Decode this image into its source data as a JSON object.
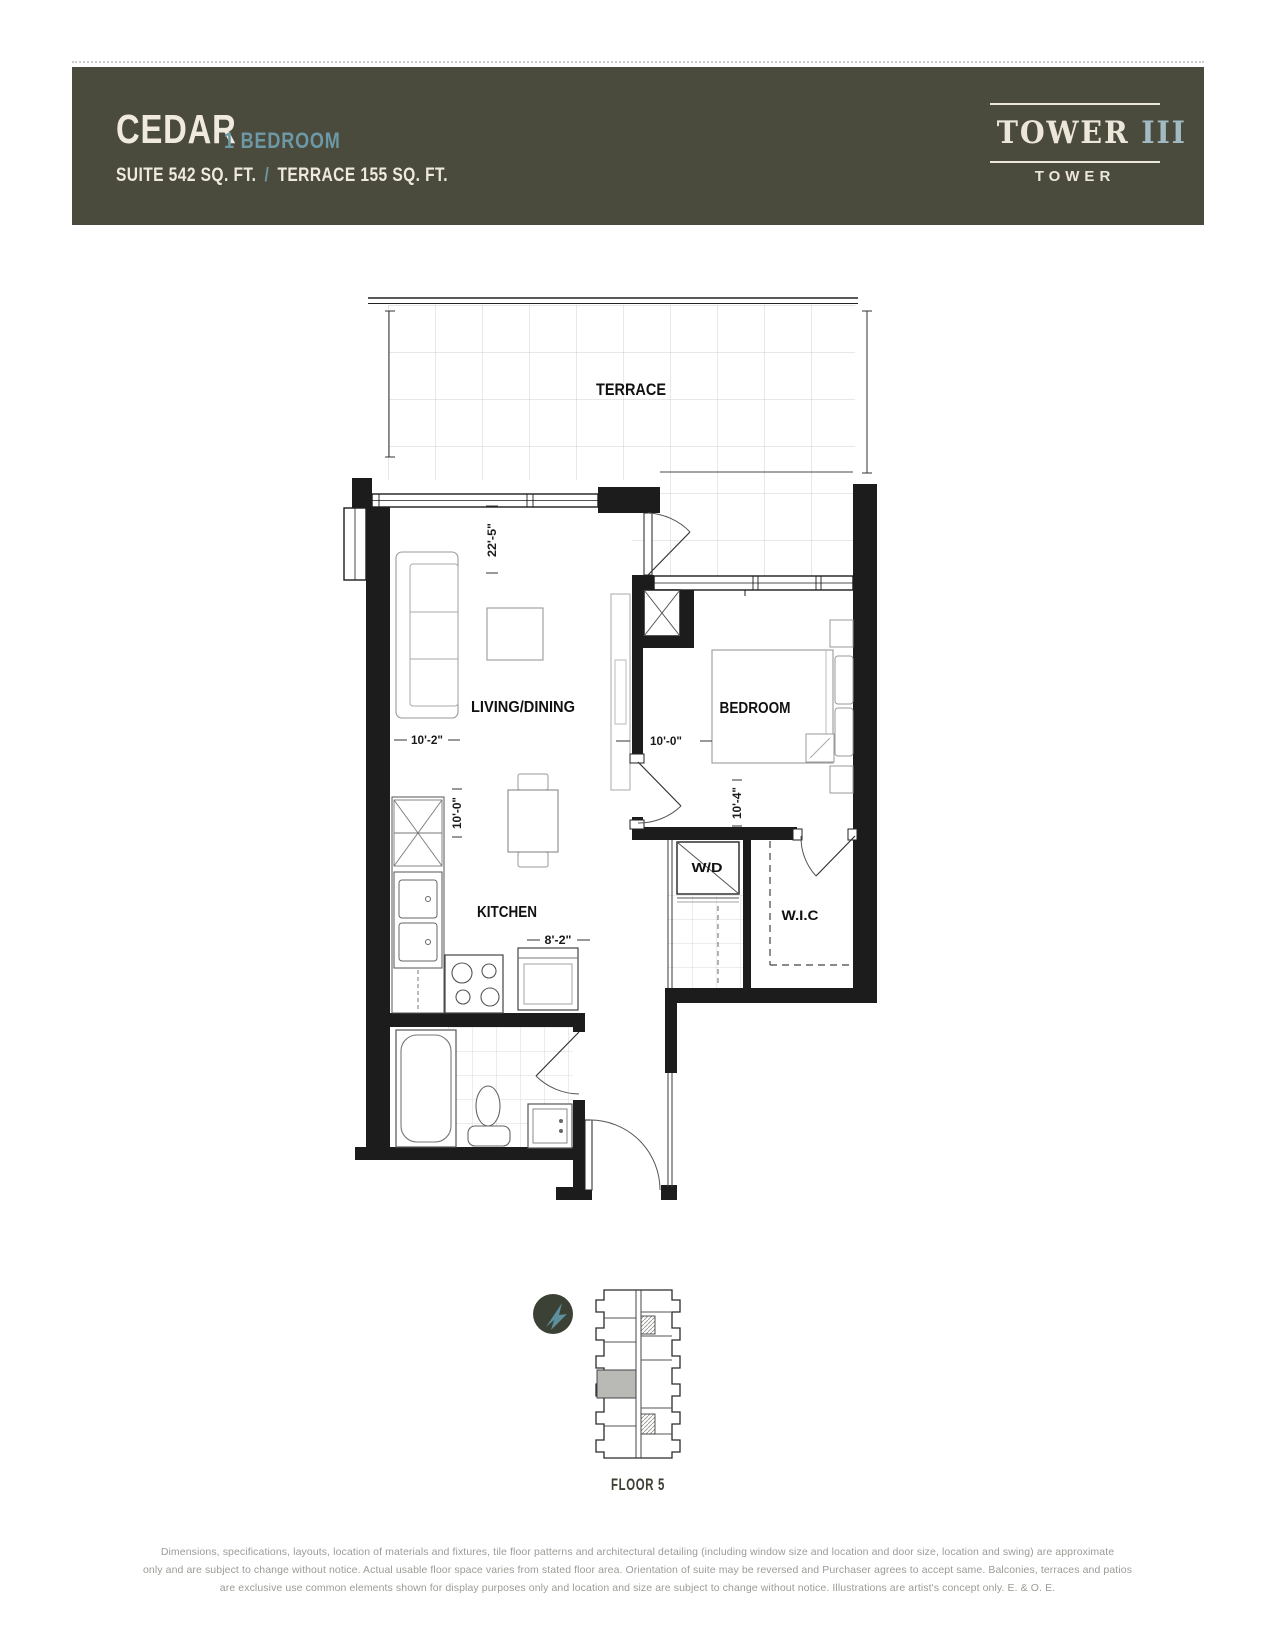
{
  "header": {
    "name": "CEDAR",
    "type": "1 BEDROOM",
    "suite_area": "SUITE 542 SQ. FT.",
    "separator": "/",
    "terrace_area": "TERRACE 155 SQ. FT."
  },
  "logo": {
    "word": "TOWER",
    "numeral": "III",
    "sub": "TOWER"
  },
  "plan": {
    "labels": {
      "terrace": "TERRACE",
      "living": "LIVING/DINING",
      "kitchen": "KITCHEN",
      "bedroom": "BEDROOM",
      "wd": "W/D",
      "wic": "W.I.C"
    },
    "dims": {
      "terrace_window": "22'-5\"",
      "living_width": "10'-2\"",
      "kitchen_depth": "10'-0\"",
      "kitchen_width": "8'-2\"",
      "bedroom_width": "10'-0\"",
      "bedroom_depth": "10'-4\""
    }
  },
  "keyplan": {
    "floor": "FLOOR 5"
  },
  "colors": {
    "header_bg": "#4a4a3d",
    "cream": "#efeadd",
    "teal": "#6d98a6",
    "unit_highlight": "#b9b9b6"
  },
  "disclaimer": {
    "line1": "Dimensions, specifications, layouts, location of materials and fixtures, tile floor patterns and architectural detailing (including window size and location and door size, location and swing) are approximate",
    "line2": "only and are subject to change without notice. Actual usable floor space varies from stated floor area. Orientation of suite may be reversed and Purchaser agrees to accept same. Balconies, terraces and patios",
    "line3": "are exclusive use common elements shown for display purposes only and location and size are subject to change without notice. Illustrations are artist's concept only. E. & O. E."
  }
}
